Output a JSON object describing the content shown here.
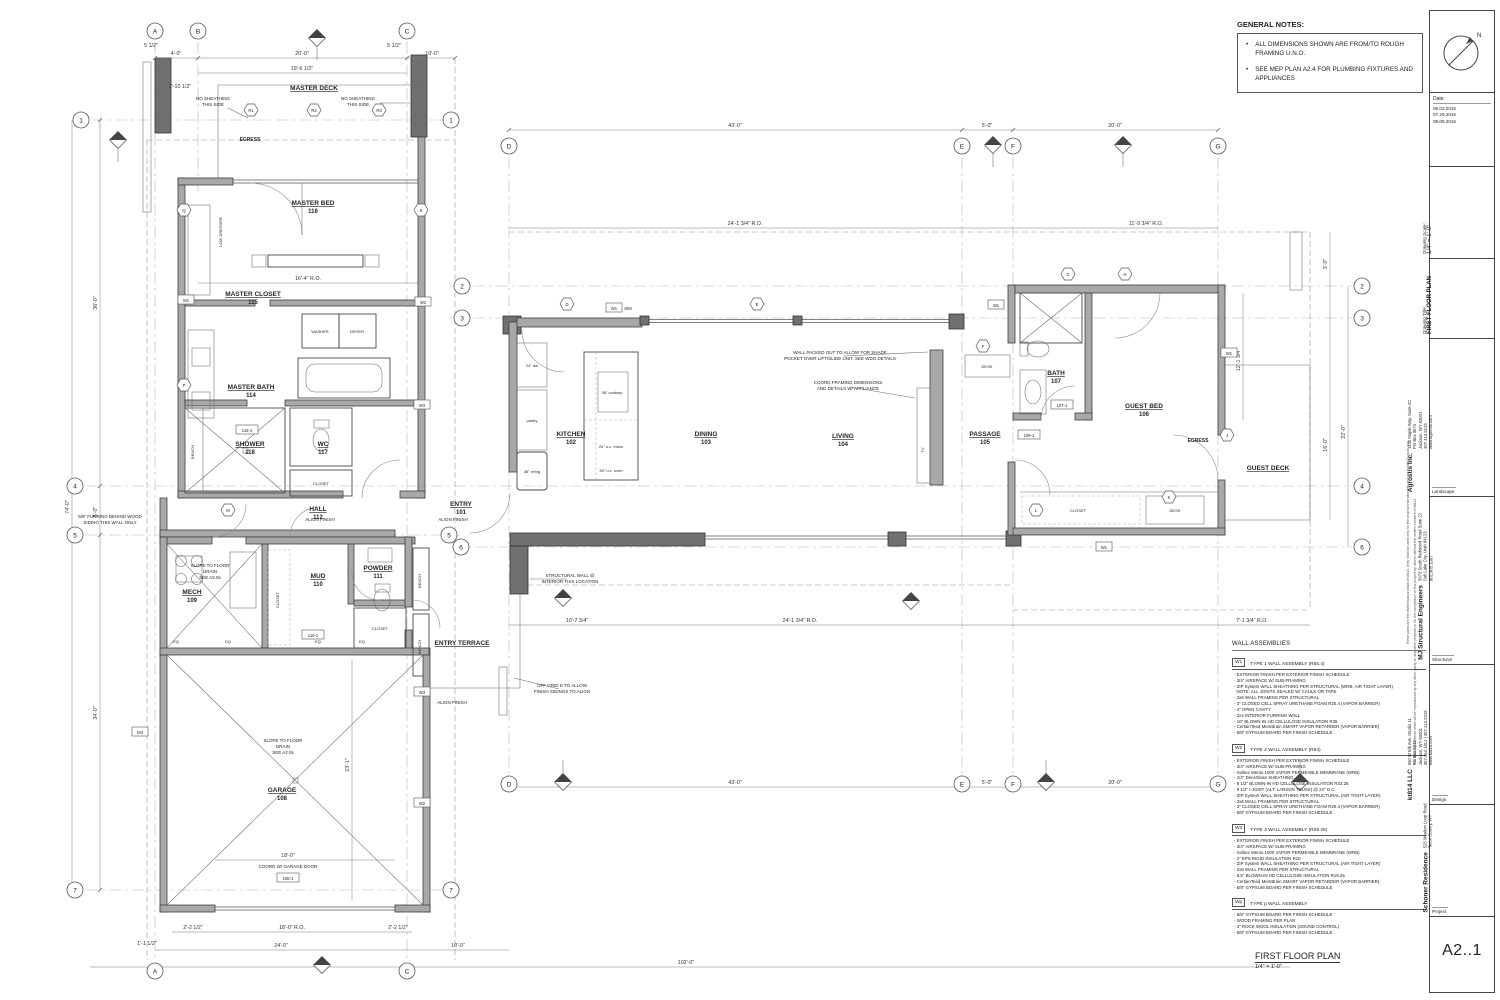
{
  "sheet": {
    "title": "FIRST FLOOR PLAN",
    "scale": "1/4\" = 1'-0\"",
    "number": "A2..1",
    "north": "N"
  },
  "general_notes": {
    "heading": "GENERAL NOTES:",
    "items": [
      "ALL DIMENSIONS SHOWN ARE FROM/TO ROUGH FRAMING U.N.O.",
      "SEE MEP PLAN A2.4 FOR PLUMBING FIXTURES AND APPLIANCES"
    ]
  },
  "title_block": {
    "date_label": "Date:",
    "dates": [
      "06.02.2015",
      "07.29.2015",
      "09.09.2015"
    ],
    "scale_label": "Drawing Scale:",
    "scale": "1/4\" = 1'-0\"",
    "title_label": "Drawing Title:",
    "title": "FIRST FLOOR PLAN",
    "firms": [
      {
        "name": "Agrostis Inc.",
        "lines": [
          "1130 Maple Way, Suite 2C",
          "PO Box 3074",
          "Jackson, WY 83001",
          "307.413.5123",
          "www.agrostis.com"
        ],
        "role": "Landscape"
      },
      {
        "name": "MJ Structural Engineers",
        "lines": [
          "5673 South Redwood Road Suite 22",
          "Salt Lake City, Utah 84123",
          "801.905.1097"
        ],
        "role": "Structural"
      },
      {
        "name": "kt814 LLC",
        "lines": [
          "650 W Elk Ave, Studio 11",
          "PO Box 8242",
          "Jackson, WY 83001",
          "307.264.1814 | 307.413.2219",
          "www.kt814.com"
        ],
        "role": "Design"
      },
      {
        "name": "Schoner Residence",
        "lines": [
          "525 Moulton Loop Road",
          "Teton County, WY"
        ],
        "role": "Project"
      }
    ],
    "disclaimer1": "these plans are the intellectual product of kt814. they shall be used only for the original intended site and are limited to such use.",
    "disclaimer2": "the drawing contents shall not be reproduced by any other party on any other projects or for the completion of this project by others without the written consent of kt814"
  },
  "wall_assemblies": {
    "heading": "WALL ASSEMBLIES",
    "types": [
      {
        "tag": "W1",
        "title": "TYPE 1 WALL ASSEMBLY (R55.4)",
        "lines": [
          "EXTERIOR FINISH PER EXTERIOR FINISH SCHEDULE",
          "3/4\" AIRSPACE W/ SUB-FRAMING",
          "ZIP System WALL SHEATHING PER STRUCTURAL (WRB, AIR TIGHT LAYER)",
          "NOTE: ALL JOINTS SEALED W/ CAULK OR TAPE",
          "2x6 WALL FRAMING PER STRUCTURAL",
          "3\" CLOSED CELL SPRAY URETHANE FOAM R20.4 (VAPOR BARRIER)",
          "4\" OPEN CAVITY",
          "2x4 INTERIOR FURRING WALL",
          "10\" BLOWN-IN HD CELLULOSE INSULATION R35",
          "CertainTeed MemBrain SMART VAPOR RETARDER (VAPOR BARRIER)",
          "5/8\" GYPSUM BOARD PER FINISH SCHEDULE"
        ]
      },
      {
        "tag": "W2",
        "title": "TYPE 2 WALL ASSEMBLY (R54)",
        "lines": [
          "EXTERIOR FINISH PER EXTERIOR FINISH SCHEDULE",
          "3/4\" AIRSPACE W/ SUB-FRAMING",
          "Solitex Mento 1000  VAPOR PERMEABLE MEMBRANE (WRB)",
          "1/2\" DensGlass SHEATHING",
          "9 1/2\" BLOWN-IN HD CELLULOSE INSULATION R33.25",
          "9 1/2\" I-JOIST (ALT: LARSON TRUSS) @ 24\" O.C.",
          "ZIP System WALL SHEATHING PER STRUCTURAL (AIR TIGHT LAYER)",
          "2x6 WALL FRAMING PER STRUCTURAL",
          "3\" CLOSED CELL SPRAY URETHANE FOAM R20.4 (VAPOR BARRIER)",
          "5/8\" GYPSUM BOARD PER FINISH SCHEDULE"
        ]
      },
      {
        "tag": "W3",
        "title": "TYPE 3 WALL ASSEMBLY (R29.25)",
        "lines": [
          "EXTERIOR FINISH PER EXTERIOR FINISH SCHEDULE",
          "3/4\" AIRSPACE W/ SUB-FRAMING",
          "Solitex Mento 1000  VAPOR PERMEABLE MEMBRANE (WRB)",
          "2\" EPS RIGID INSULATION R10",
          "ZIP System WALL SHEATHING PER STRUCTURAL (AIR TIGHT LAYER)",
          "2x6 WALL FRAMING PER STRUCTURAL",
          "5.5\" BLOWN-IN HD CELLULOSE INSULATION R19.25",
          "CertainTeed MemBrain SMART VAPOR RETARDER (VAPOR BARRIER)",
          "5/8\" GYPSUM BOARD PER FINISH SCHEDULE"
        ]
      },
      {
        "tag": "Wp",
        "title": "TYPE p WALL ASSEMBLY",
        "lines": [
          "5/8\" GYPSUM BOARD PER FINISH SCHEDULE",
          "WOOD FRAMING PER PLAN",
          "3\" ROCK WOOL INSULATION (SOUND CONTROL)",
          "5/8\" GYPSUM BOARD PER FINISH SCHEDULE"
        ]
      }
    ]
  },
  "plan": {
    "rooms": {
      "master_deck": {
        "name": "MASTER DECK",
        "num": ""
      },
      "master_bed": {
        "name": "MASTER BED",
        "num": "116"
      },
      "master_closet": {
        "name": "MASTER CLOSET",
        "num": "115"
      },
      "master_bath": {
        "name": "MASTER BATH",
        "num": "114"
      },
      "shower": {
        "name": "SHOWER",
        "num": "118"
      },
      "wc": {
        "name": "WC",
        "num": "117"
      },
      "hall": {
        "name": "HALL",
        "num": "112"
      },
      "entry": {
        "name": "ENTRY",
        "num": "101"
      },
      "mech": {
        "name": "MECH",
        "num": "109"
      },
      "mud": {
        "name": "MUD",
        "num": "110"
      },
      "powder": {
        "name": "POWDER",
        "num": "111"
      },
      "entry_terrace": {
        "name": "ENTRY TERRACE",
        "num": ""
      },
      "garage": {
        "name": "GARAGE",
        "num": "108"
      },
      "kitchen": {
        "name": "KITCHEN",
        "num": "102"
      },
      "dining": {
        "name": "DINING",
        "num": "103"
      },
      "living": {
        "name": "LIVING",
        "num": "104"
      },
      "passage": {
        "name": "PASSAGE",
        "num": "105"
      },
      "bath": {
        "name": "BATH",
        "num": "107"
      },
      "guest_bed": {
        "name": "GUEST BED",
        "num": "106"
      },
      "guest_deck": {
        "name": "GUEST DECK",
        "num": ""
      },
      "egress": {
        "name": "EGRESS",
        "num": ""
      }
    },
    "fixtures": {
      "washer": "WASHER",
      "dryer": "DRYER",
      "pantry": "pantry",
      "refrig": "36\" refrig",
      "dw": "24\" dw",
      "cooktop": "36\" cooktop",
      "micro": "24\" u.c. micro",
      "oven": "30\" u.c. oven",
      "tv": "TV",
      "desk": "DESK",
      "closet": "CLOSET",
      "bench": "BENCH",
      "low_dresser": "LOW DRESSER",
      "eq": "EQ"
    },
    "annotations": {
      "no_sheathing": [
        "NO SHEATHING",
        "THIS SIDE"
      ],
      "shade_pocket": [
        "WALL PACKED OUT TO ALLOW FOR SHADE",
        "POCKET OVER LIFT/SLIDE UNIT. SEE WDO DETAILS"
      ],
      "coord_framing": [
        "COORD FRAMING DIMENSIONS",
        "AND DETAILS W/ APPLIANCE"
      ],
      "structural_wall": [
        "STRUCTURAL WALL @",
        "INTERIOR THIS LOCATION"
      ],
      "off_grid": [
        "OFF GRID D TO ALLOW",
        "FINISH SIDINGS TO ALIGN"
      ],
      "slope_drain": [
        "SLOPE TO FLOOR",
        "DRAIN",
        "SEE A2.0s"
      ],
      "coord_garage": "COORD W/ GARAGE DOOR",
      "furring": [
        "5/8\" FURRING BEHIND WOOD",
        "SIDING  THIS WALL ONLY"
      ],
      "align_finish": "ALIGN FINISH"
    },
    "dims": {
      "a_b": "4'-0\"",
      "b_c": "20'-0\"",
      "c_r": "10'-0\"",
      "d_e": "43'-0\"",
      "e_f": "5'-0\"",
      "f_g": "20'-0\"",
      "deck_w": "19'-6 1/2\"",
      "bed_ro": "16'-4\" R.O.",
      "total_h": "74'-0\"",
      "h14": "36'-0\"",
      "h45": "5'-0\"",
      "h57": "34'-0\"",
      "a_c": "24'-0\"",
      "total_w": "102'-0\"",
      "gar_door": "18'-0\"",
      "gar_ro": "18'-0\" R.O.",
      "gar_d": "23'-1\"",
      "ctr_ro": "24'-1 3/4\" R.O.",
      "guest_ro": "11'-9 3/4\" R.O.",
      "r22": "22'-0\"",
      "deck16": "16'-0\"",
      "r3": "3'-0\"",
      "s107": "10'-7 3/4\"",
      "s71": "7'-1 3/4\" R.O.",
      "guest_h": "12'-1 3/4\"",
      "t2212": "2'-2 1/2\"",
      "t1112": "1'-1 1/2\"",
      "t21012": "2'-10 1/2\"",
      "t512": "5 1/2\""
    },
    "grid": {
      "letters": [
        "A",
        "B",
        "C",
        "D",
        "E",
        "F",
        "G"
      ],
      "numbers": [
        "1",
        "2",
        "3",
        "4",
        "5",
        "6",
        "7"
      ]
    },
    "hex": {
      "r1": "R1",
      "r2": "R2",
      "r3": "R3",
      "q": "Q",
      "s": "S",
      "p": "P",
      "m": "M",
      "d": "D",
      "e": "E",
      "f": "F",
      "g": "G",
      "h": "H",
      "j": "J",
      "k": "K",
      "l": "L"
    },
    "wall_tags": {
      "w1": "W1",
      "w2": "W2",
      "w3": "W3",
      "sim": "SIM"
    },
    "door_tags": {
      "t108": "108-1",
      "t110": "110-1",
      "t116": "116-1",
      "t106": "106-1",
      "t107": "107-1"
    }
  }
}
